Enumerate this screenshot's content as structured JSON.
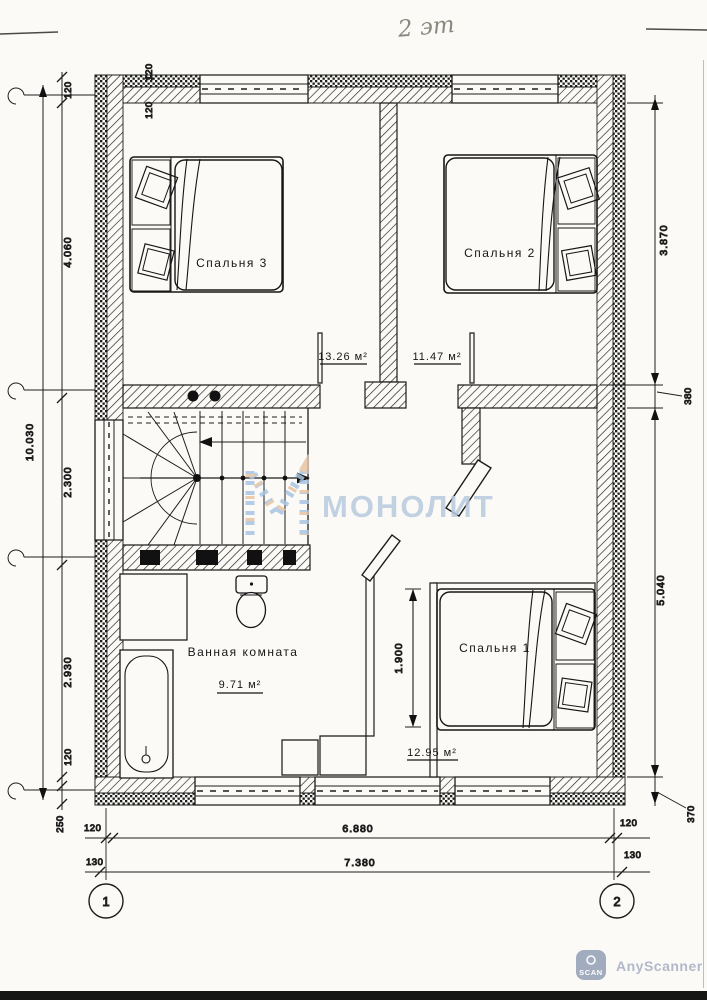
{
  "handwriting": {
    "floor_note": "2 эт"
  },
  "rooms": {
    "bedroom3": {
      "label": "Спальня 3",
      "area": "13.26 м²"
    },
    "bedroom2": {
      "label": "Спальня 2",
      "area": "11.47 м²"
    },
    "bedroom1": {
      "label": "Спальня 1",
      "area": "12.95 м²"
    },
    "bathroom": {
      "label": "Ванная комната",
      "area": "9.71 м²"
    }
  },
  "dims": {
    "d120": "120",
    "d130": "130",
    "d250": "250",
    "d370": "370",
    "d380": "380",
    "left_overall": "10.030",
    "bedroom3_depth": "4.060",
    "stair_depth": "2.300",
    "bathroom_depth": "2.930",
    "bedroom2_depth": "3.870",
    "bedroom1_depth": "5.040",
    "width_inner": "6.880",
    "width_outer": "7.380",
    "bedroom1_hall": "1.900"
  },
  "axes": {
    "axis1": "1",
    "axis2": "2"
  },
  "watermark": {
    "brand": "МОНОЛИТ",
    "color": "#b9cade",
    "logo_blue": "#a8c5e2",
    "logo_orange": "#e9c3a2"
  },
  "scanner": {
    "icon_text": "SCAN",
    "label": "AnyScanner",
    "color": "#a9b3c5"
  }
}
